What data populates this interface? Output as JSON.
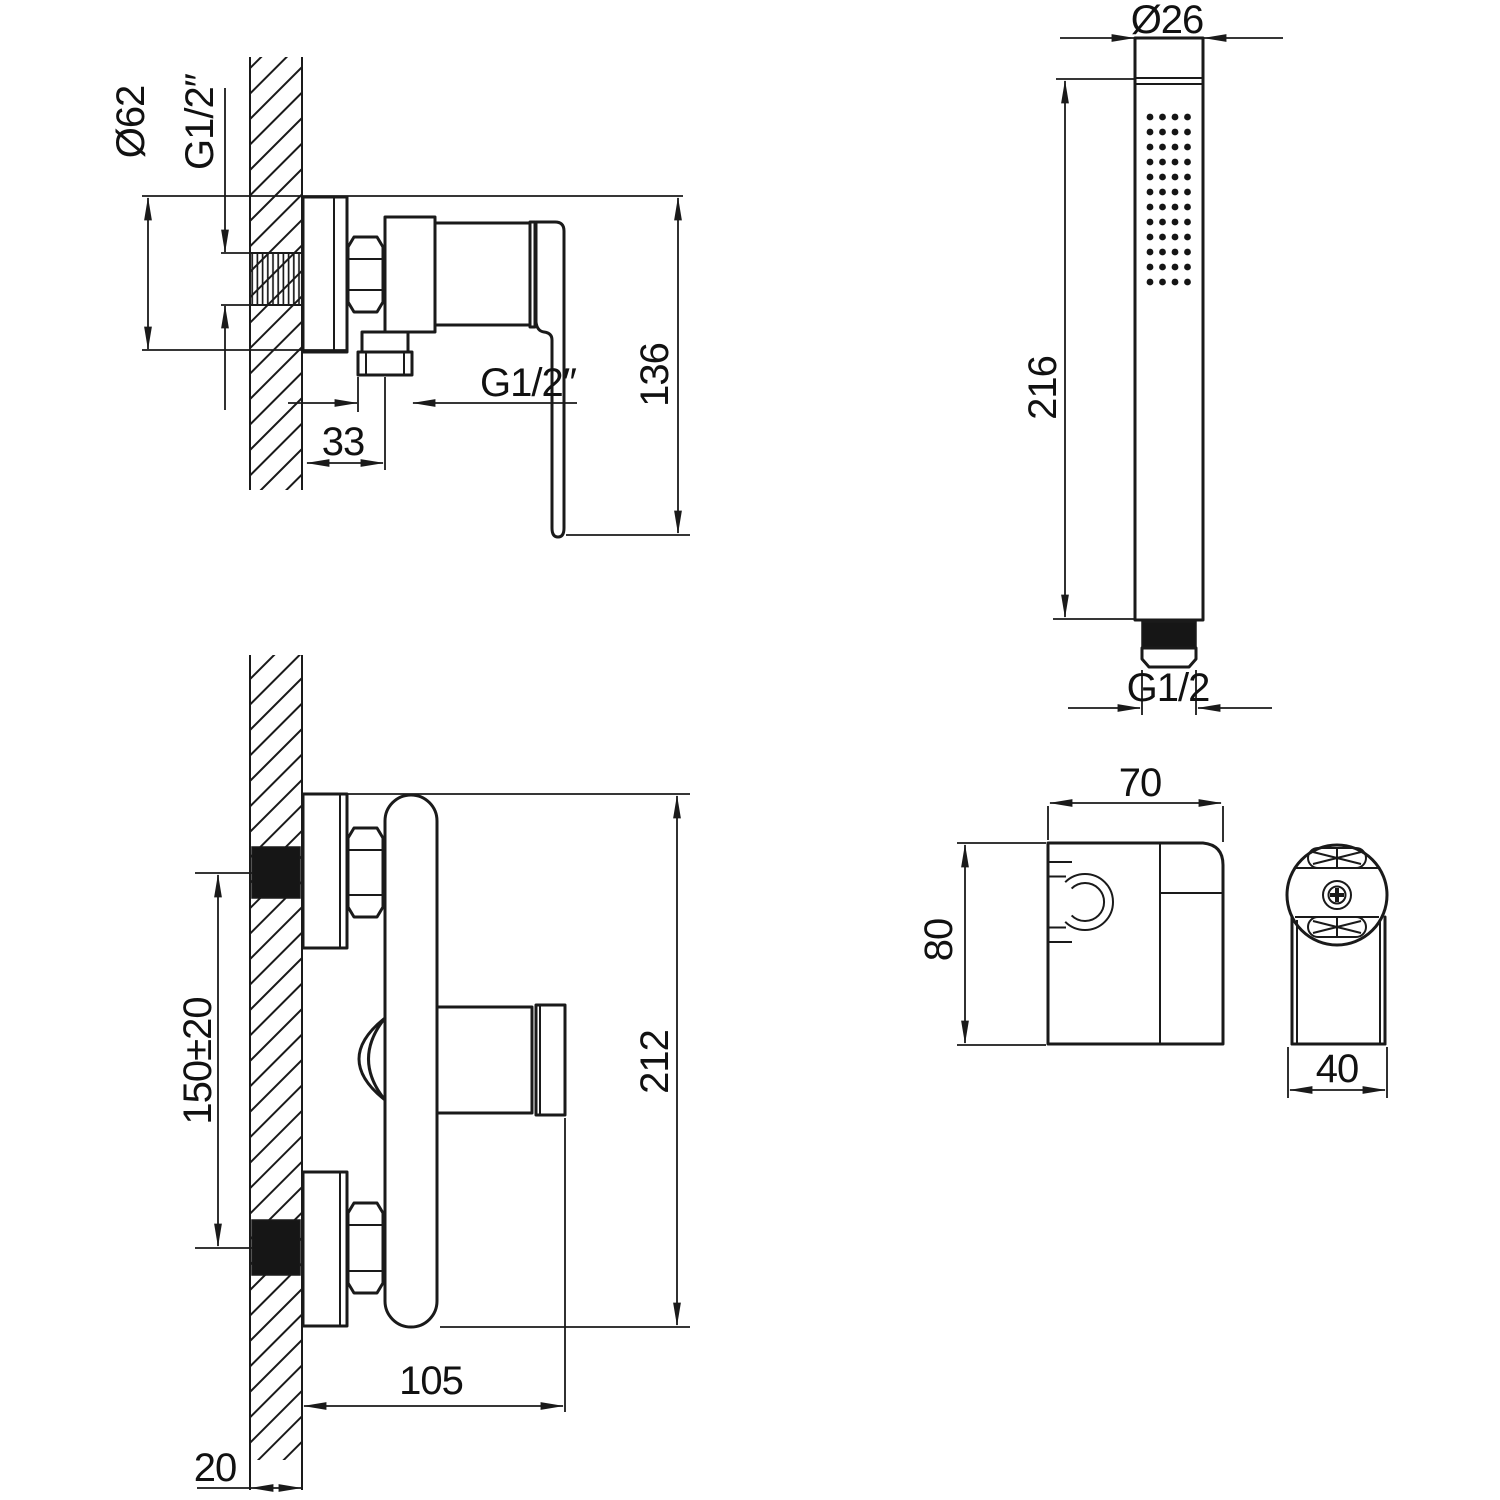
{
  "drawing": {
    "colors": {
      "line": "#1a1a1a",
      "background": "#ffffff"
    },
    "mixer_top_view": {
      "escutcheon_diameter": "Ø62",
      "wall_thread": "G1/2″",
      "total_height": "136",
      "outlet_thread": "G1/2″",
      "outlet_offset": "33"
    },
    "mixer_front_view": {
      "inlet_spacing": "150±20",
      "total_height": "212",
      "depth": "105",
      "wall_thickness": "20"
    },
    "handshower_view": {
      "head_diameter": "Ø26",
      "length": "216",
      "thread": "G1/2"
    },
    "holder_side_view": {
      "width": "70",
      "height": "80"
    },
    "holder_front_view": {
      "depth": "40"
    }
  }
}
